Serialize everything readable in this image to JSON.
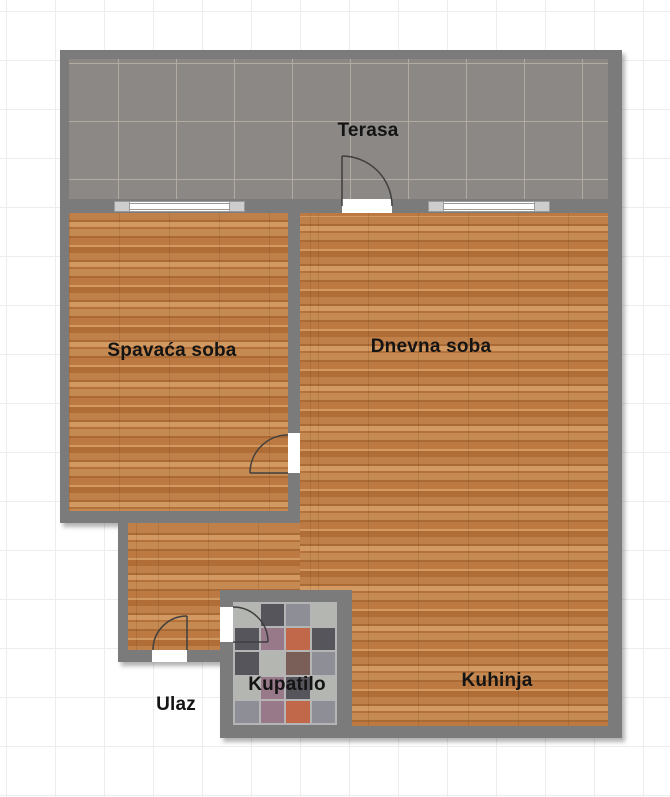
{
  "page": {
    "type": "apartment-floor-plan"
  },
  "rooms": {
    "terrace": {
      "label": "Terasa"
    },
    "bedroom": {
      "label": "Spavaća soba"
    },
    "living_room": {
      "label": "Dnevna soba"
    },
    "bathroom": {
      "label": "Kupatilo"
    },
    "entrance": {
      "label": "Ulaz"
    },
    "kitchen": {
      "label": "Kuhinja"
    }
  },
  "colors": {
    "wall": "#7b7b7b",
    "terrace_tile": "#8c8885",
    "terrace_grout": "#b3aaa2",
    "wood_base": "#c08049",
    "wood_dark": "#a96a35",
    "wood_light": "#d29a62",
    "bath_grout": "#b5b5b5",
    "door_arc": "#3f3f3f",
    "window_frame": "#9a9a9a",
    "window_cap": "#cdcdcd",
    "label_text": "#141414",
    "grid_line": "#ededed",
    "bath_palette": [
      "#8e8e96",
      "#57555c",
      "#b4b6b1",
      "#c2684a",
      "#97798a",
      "#7a5f58"
    ]
  }
}
